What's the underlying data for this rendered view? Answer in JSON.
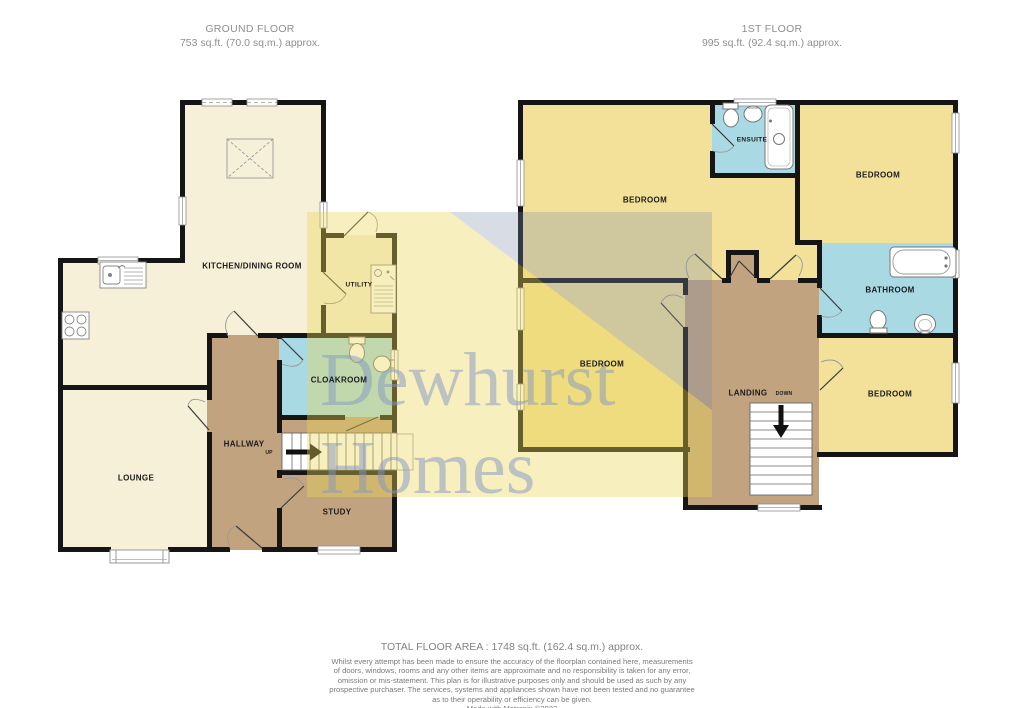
{
  "headers": {
    "ground": {
      "title": "GROUND FLOOR",
      "area": "753 sq.ft. (70.0 sq.m.) approx."
    },
    "first": {
      "title": "1ST FLOOR",
      "area": "995 sq.ft. (92.4 sq.m.) approx."
    }
  },
  "watermark": {
    "line1": "Dewhurst",
    "line2": "Homes"
  },
  "ground_floor": {
    "rooms": {
      "kitchen": "KITCHEN/DINING ROOM",
      "lounge": "LOUNGE",
      "hallway": "HALLWAY",
      "cloakroom": "CLOAKROOM",
      "study": "STUDY",
      "utility": "UTILITY"
    },
    "stairs": {
      "direction": "UP"
    }
  },
  "first_floor": {
    "rooms": {
      "bedroom_top_left": "BEDROOM",
      "bedroom_top_right": "BEDROOM",
      "bedroom_mid_left": "BEDROOM",
      "bedroom_bottom_right": "BEDROOM",
      "ensuite": "ENSUITE",
      "bathroom": "BATHROOM",
      "landing": "LANDING"
    },
    "stairs": {
      "direction": "DOWN"
    }
  },
  "footer": {
    "total_area": "TOTAL FLOOR AREA : 1748 sq.ft. (162.4 sq.m.) approx.",
    "disclaimer": [
      "Whilst every attempt has been made to ensure the accuracy of the floorplan contained here, measurements",
      "of doors, windows, rooms and any other items are approximate and no responsibility is taken for any error,",
      "omission or mis-statement. This plan is for illustrative purposes only and should be used as such by any",
      "prospective purchaser. The services, systems and appliances shown have not been tested and no guarantee",
      "as to their operability or efficiency can be given."
    ],
    "credit": "Made with Metropix ©2023"
  },
  "colors": {
    "wall": "#151515",
    "room_cream": "#f6f0d8",
    "room_yellow": "#f3e19a",
    "room_blue": "#a9dae4",
    "room_brown": "#c2a37f",
    "watermark_yellow": "#e9d555",
    "watermark_blue": "#7d8aaa",
    "watermark_text": "#8296c3",
    "heading_grey": "#8f8f8f",
    "footer_grey": "#7a7a7a"
  }
}
